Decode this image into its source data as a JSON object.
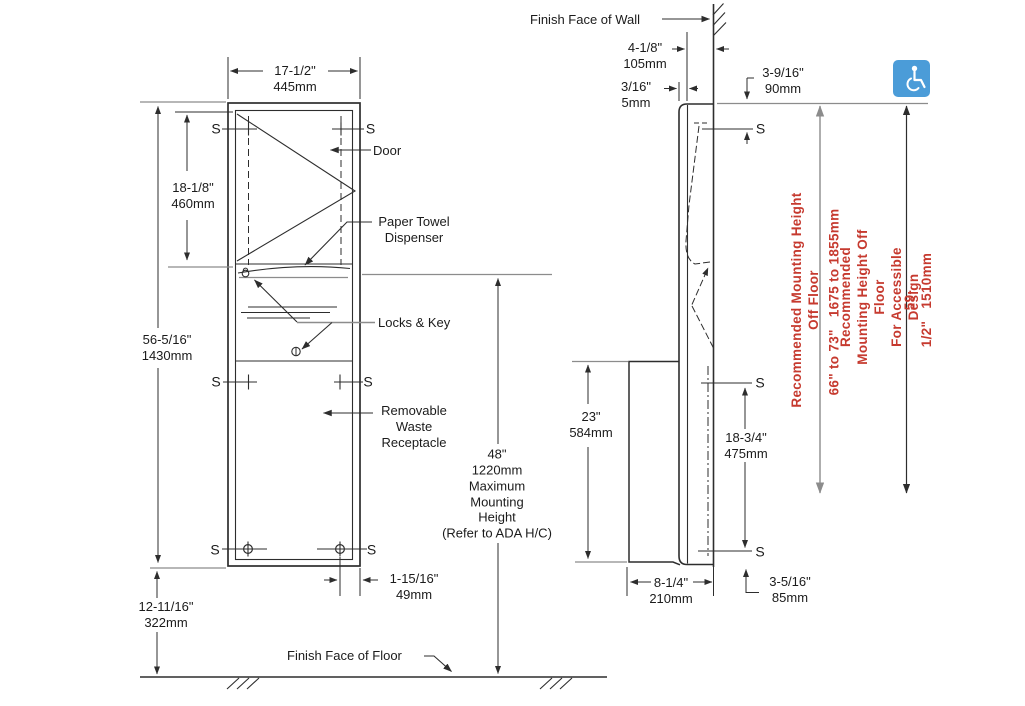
{
  "colors": {
    "accent_red": "#c63a2f",
    "icon_blue": "#4b9cd8",
    "line_dark": "#2d2d2d",
    "line_gray": "#8c8c8c"
  },
  "front_view": {
    "dim_width": "17-1/2\"\n445mm",
    "dim_door_height": "18-1/8\"\n460mm",
    "dim_overall_height": "56-5/16\"\n1430mm",
    "dim_floor_offset": "12-11/16\"\n322mm",
    "dim_mounting_height": "48\"\n1220mm\nMaximum\nMounting\nHeight\n(Refer to ADA H/C)",
    "dim_hole_inset": "1-15/16\"\n49mm",
    "label_door": "Door",
    "label_dispenser": "Paper Towel\nDispenser",
    "label_locks": "Locks & Key",
    "label_waste": "Removable\nWaste\nReceptacle",
    "label_floor": "Finish Face of Floor"
  },
  "side_view": {
    "label_wall": "Finish Face of Wall",
    "dim_projection": "4-1/8\"\n105mm",
    "dim_flange": "3/16\"\n5mm",
    "dim_top_fastener": "3-9/16\"\n90mm",
    "dim_receptacle_height": "23\"\n584mm",
    "dim_fastener_span": "18-3/4\"\n475mm",
    "dim_depth": "8-1/4\"\n210mm",
    "dim_bottom_fastener": "3-5/16\"\n85mm"
  },
  "mounting_notes": {
    "standard_label": "Recommended Mounting Height Off Floor",
    "standard_range": "66\" to 73\"   1675 to 1855mm",
    "accessible_label": "Recommended Mounting Height Off Floor\nFor Accessible Design",
    "accessible_range": "59-1/2\"   1510mm"
  },
  "markers": {
    "fastener": "S"
  },
  "icons": {
    "accessibility": "wheelchair-accessible-icon"
  }
}
